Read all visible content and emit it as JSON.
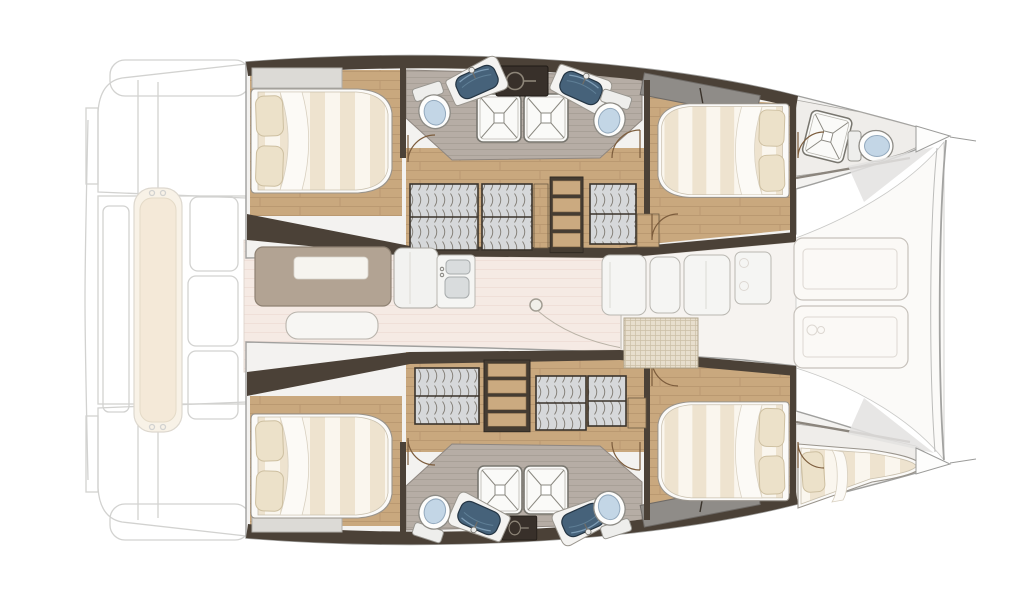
{
  "meta": {
    "title": "Catamaran sailing yacht interior layout — top-view floor plan",
    "style": "rendered technical boat plan, no text labels",
    "background": "#ffffff",
    "orientation": {
      "bow": "right",
      "stern": "left",
      "port_hull": "top",
      "starboard_hull": "bottom"
    }
  },
  "colors": {
    "hull_outline": "#a0a09e",
    "ghost": "#d2d2d0",
    "wood_floor": "#c9a87e",
    "wood_plank_line": "#b5946c",
    "bath_floor": "#b6ada5",
    "bath_floor_line": "#a59c94",
    "wall_dark": "#4b4137",
    "wall_frame": "#3a332b",
    "wardrobe_front": "#d6d8da",
    "wardrobe_stripe": "#7f7a72",
    "bed_linen": "#faf6ee",
    "bed_stripe": "#eee3cf",
    "pillow": "#ece1c9",
    "saloon_floor": "#f5eae4",
    "deck_white": "#f3f2f0",
    "cockpit_floor": "#fbfaf8",
    "cushion": "#fbf9f6",
    "sunpad": "#f4e9d8",
    "sink_basin": "#46627a",
    "toilet_seat": "#c3d6e6",
    "shower_tray": "#fafaf8",
    "table_top": "#b2a393",
    "appliance_dark": "#38302a",
    "door_arc": "#7c5c3c",
    "mesh_hatch": "#e7decd"
  },
  "layout": {
    "stern_cockpit": {
      "rendering": "ghosted outline",
      "elements": [
        "aft crossbeam port",
        "aft crossbeam starboard",
        "transom steps port",
        "transom steps starboard",
        "swim platform edge",
        "cockpit sunpad bench",
        "cockpit floor panels",
        "side deck panel"
      ]
    },
    "port_hull": {
      "position": "top",
      "rooms": [
        {
          "name": "aft cabin",
          "furniture": [
            "island double berth",
            "two pillows",
            "headboard shelf"
          ]
        },
        {
          "name": "aft heads",
          "fixtures": [
            "toilet",
            "angled washbasin",
            "shower tray",
            "dark technical locker"
          ]
        },
        {
          "name": "forward heads",
          "fixtures": [
            "toilet",
            "angled washbasin",
            "shower tray"
          ]
        },
        {
          "name": "companionway",
          "fixtures": [
            "wardrobe",
            "wardrobe",
            "staircase down to hull",
            "wardrobe",
            "side shelf"
          ]
        },
        {
          "name": "forward cabin",
          "furniture": [
            "island double berth",
            "two pillows",
            "overhead lockers"
          ]
        },
        {
          "name": "forepeak head",
          "fixtures": [
            "angled shower tray",
            "toilet",
            "diagonal partition"
          ]
        }
      ]
    },
    "starboard_hull": {
      "position": "bottom",
      "rooms": [
        {
          "name": "aft cabin",
          "furniture": [
            "island double berth",
            "two pillows",
            "headboard shelf"
          ]
        },
        {
          "name": "aft heads",
          "fixtures": [
            "toilet",
            "angled washbasin",
            "shower tray",
            "dark technical locker"
          ]
        },
        {
          "name": "forward heads",
          "fixtures": [
            "toilet",
            "angled washbasin",
            "shower tray"
          ]
        },
        {
          "name": "companionway",
          "fixtures": [
            "wardrobe",
            "staircase down to hull",
            "wardrobe",
            "wardrobe",
            "side shelf"
          ]
        },
        {
          "name": "forward cabin",
          "furniture": [
            "island double berth",
            "two pillows",
            "overhead lockers"
          ]
        },
        {
          "name": "forepeak berth",
          "furniture": [
            "wedge single berth",
            "pillow"
          ]
        }
      ]
    },
    "saloon": {
      "position": "center bridgedeck",
      "furniture": [
        "dining table",
        "white table tray",
        "sofa bench",
        "galley counter",
        "double galley sink",
        "faucet",
        "mast post",
        "rigging line",
        "galley cabinet row",
        "fridge with twin latches",
        "woven deck hatch",
        "threshold to forward area"
      ]
    },
    "forward_cockpit": {
      "furniture": [
        "lounge cushion forward-port",
        "lounge cushion forward-starboard with drain detail",
        "non-skid deck pad port",
        "non-skid deck pad starboard"
      ]
    },
    "bow": {
      "elements": [
        "forward crossbeam outer curve",
        "forward crossbeam inner curve",
        "port bow tip",
        "starboard bow tip",
        "port bowsprit line",
        "starboard bowsprit line"
      ]
    },
    "counts": {
      "double_cabins": 4,
      "single_berths": 1,
      "heads_with_shower": 4,
      "forepeak_wc": 1,
      "staircases": 2
    }
  }
}
